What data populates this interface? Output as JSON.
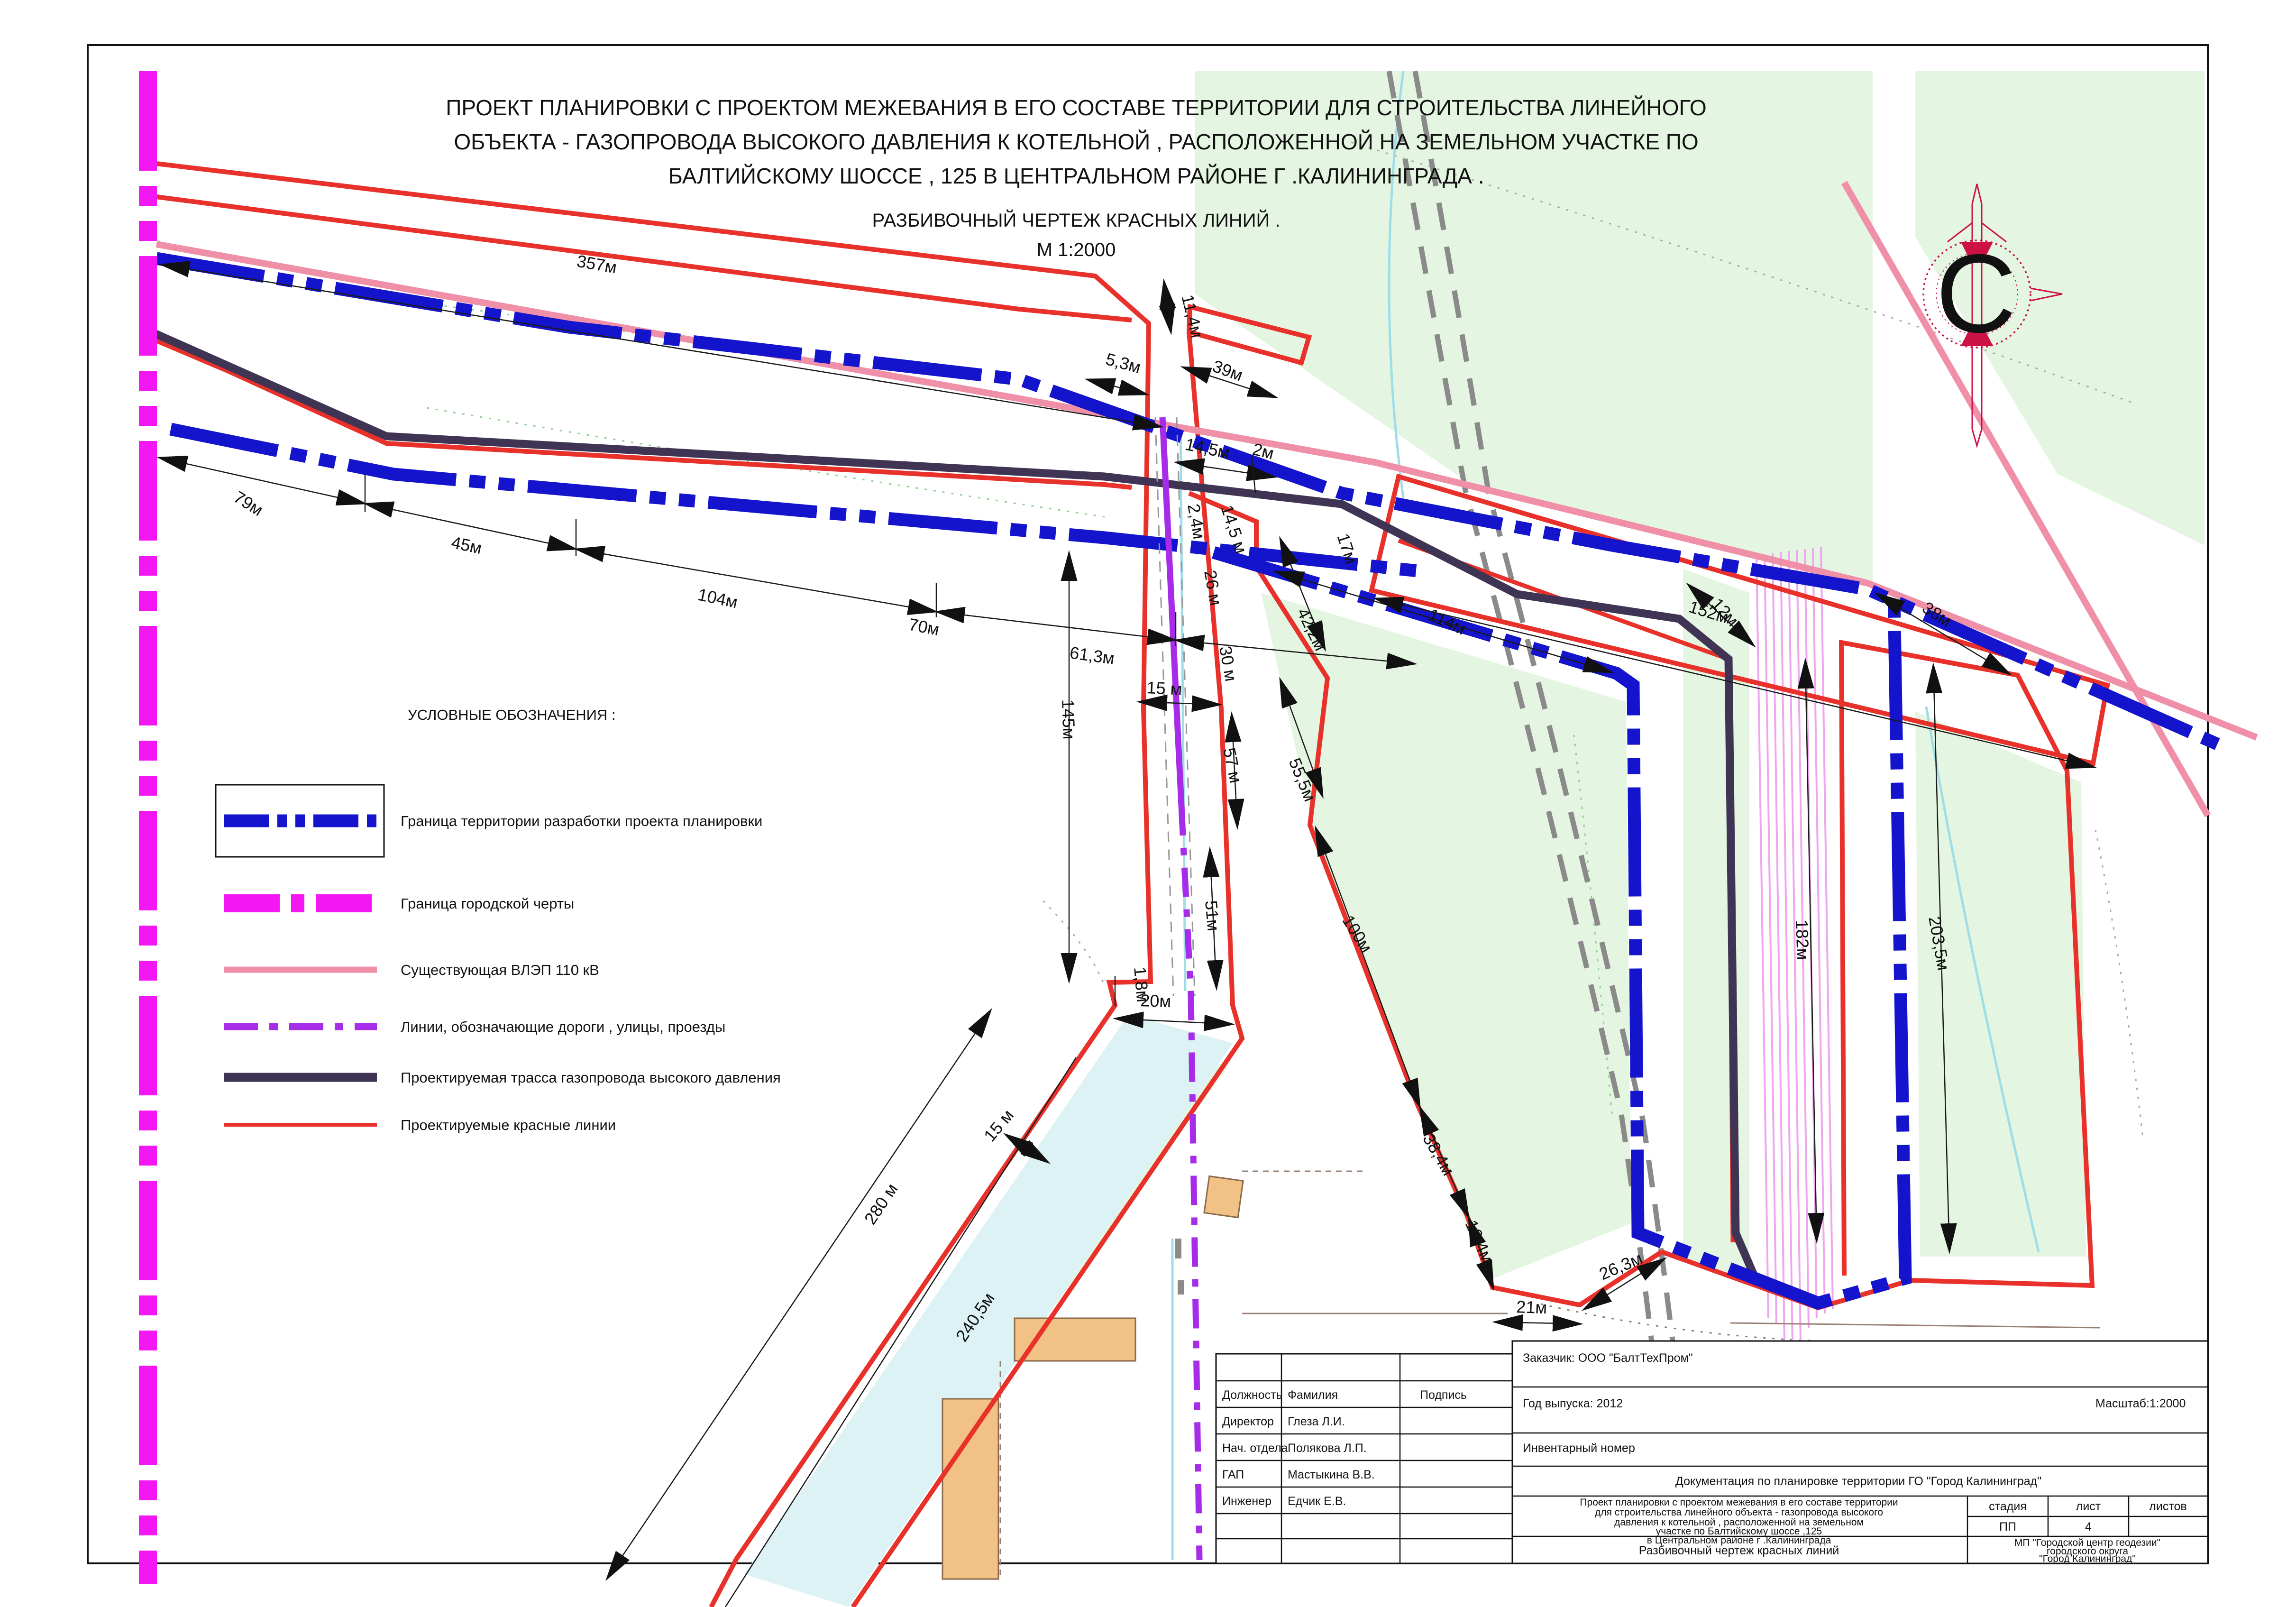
{
  "title": {
    "line1": "ПРОЕКТ ПЛАНИРОВКИ  С ПРОЕКТОМ МЕЖЕВАНИЯ В ЕГО СОСТАВЕ ТЕРРИТОРИИ ДЛЯ СТРОИТЕЛЬСТВА ЛИНЕЙНОГО",
    "line2": "ОБЪЕКТА  - ГАЗОПРОВОДА ВЫСОКОГО ДАВЛЕНИЯ К КОТЕЛЬНОЙ , РАСПОЛОЖЕННОЙ НА ЗЕМЕЛЬНОМ УЧАСТКЕ ПО",
    "line3": "БАЛТИЙСКОМУ ШОССЕ , 125 В ЦЕНТРАЛЬНОМ РАЙОНЕ Г .КАЛИНИНГРАДА .",
    "subtitle": "РАЗБИВОЧНЫЙ ЧЕРТЕЖ КРАСНЫХ ЛИНИЙ .",
    "scale": "М 1:2000"
  },
  "compass": {
    "letter": "С"
  },
  "legend": {
    "title": "УСЛОВНЫЕ ОБОЗНАЧЕНИЯ :",
    "items": [
      {
        "label": "Граница территории разработки проекта планировки"
      },
      {
        "label": "Граница городской черты"
      },
      {
        "label": "Существующая ВЛЭП  110 кВ"
      },
      {
        "label": "Линии, обозначающие дороги , улицы, проезды"
      },
      {
        "label": "Проектируемая трасса газопровода высокого давления"
      },
      {
        "label": "Проектируемые красные линии"
      }
    ]
  },
  "map": {
    "labels": [
      {
        "text": "357м"
      },
      {
        "text": "79м"
      },
      {
        "text": "45м"
      },
      {
        "text": "104м"
      },
      {
        "text": "70м"
      },
      {
        "text": "61,3м"
      },
      {
        "text": "11,4м"
      },
      {
        "text": "5,3м"
      },
      {
        "text": "39м"
      },
      {
        "text": "14,5м"
      },
      {
        "text": "2м"
      },
      {
        "text": "152м"
      },
      {
        "text": "2,4м"
      },
      {
        "text": "14,5 м"
      },
      {
        "text": "26 м"
      },
      {
        "text": "30 м"
      },
      {
        "text": "17м"
      },
      {
        "text": "145м"
      },
      {
        "text": "15 м"
      },
      {
        "text": "57 м"
      },
      {
        "text": "51м"
      },
      {
        "text": "1,8м"
      },
      {
        "text": "20м"
      },
      {
        "text": "42,2м"
      },
      {
        "text": "114м"
      },
      {
        "text": "55,5м"
      },
      {
        "text": "12м"
      },
      {
        "text": "38м"
      },
      {
        "text": "100м"
      },
      {
        "text": "38,4м"
      },
      {
        "text": "16,4м"
      },
      {
        "text": "21м"
      },
      {
        "text": "26,3м"
      },
      {
        "text": "182м"
      },
      {
        "text": "203,5м"
      },
      {
        "text": "280 м"
      },
      {
        "text": "15 м"
      },
      {
        "text": "240,5м"
      }
    ]
  },
  "stamp": {
    "customer": "Заказчик: ООО \"БалтТехПром\"",
    "year": "Год выпуска: 2012",
    "scale_label": "Масштаб:1:2000",
    "inventory": "Инвентарный номер",
    "doc_title": "Документация по планировке территории ГО \"Город Калининград\"",
    "project_lines": [
      "Проект планировки с проектом межевания в его составе территории",
      "для строительства линейного объекта   - газопровода высокого",
      "давления к котельной , расположенной на земельном",
      "участке по Балтийскому шоссе  ,125",
      "в  Центральном районе г .Калининграда"
    ],
    "drawing_name": "Разбивочный чертеж красных линий",
    "org_lines": [
      "МП \"Городской центр геодезии\"",
      "городского округа",
      "\"Город Калининград\""
    ],
    "stage_header": {
      "stage": "стадия",
      "sheet": "лист",
      "sheets": "листов"
    },
    "stage_values": {
      "stage": "ПП",
      "sheet": "4",
      "sheets": ""
    },
    "table": {
      "headers": [
        "Должность",
        "Фамилия",
        "Подпись"
      ],
      "rows": [
        [
          "Директор",
          "Глеза Л.И."
        ],
        [
          "Нач. отдела",
          "Полякова Л.П."
        ],
        [
          "ГАП",
          "Мастыкина В.В."
        ],
        [
          "Инженер",
          "Едчик Е.В."
        ]
      ]
    }
  },
  "colors": {
    "boundary_blue": "#1414cc",
    "city_magenta": "#f318f3",
    "vlep_pink": "#f08fa8",
    "road_violet": "#a62ce8",
    "pipeline_dark": "#3f3453",
    "red_line": "#e8312a",
    "green_area": "#e4f6e1",
    "rail_gray": "#8a8a8a",
    "compass_crimson": "#cc1144"
  }
}
